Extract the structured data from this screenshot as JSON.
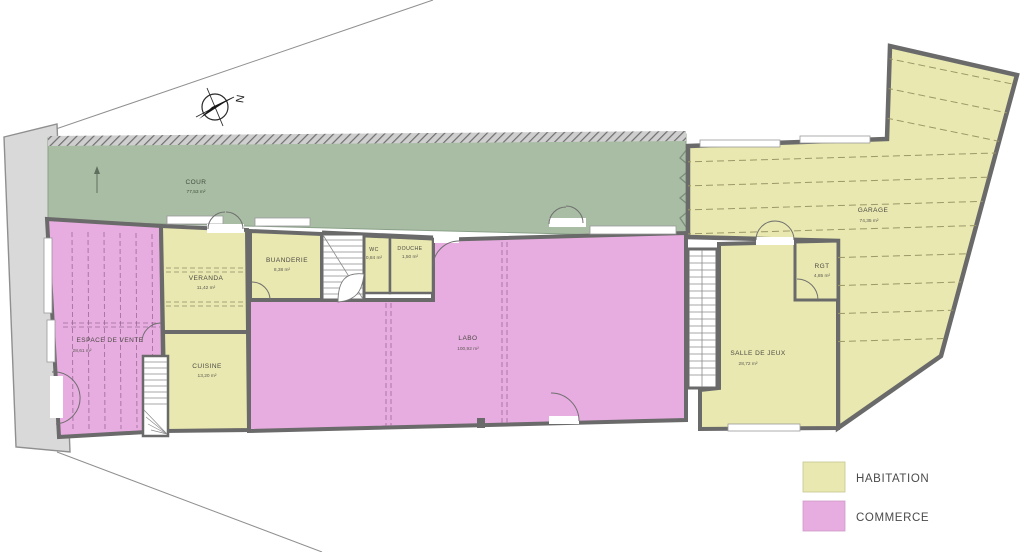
{
  "compass": {
    "label": "N"
  },
  "rooms": [
    {
      "id": "cour",
      "name": "COUR",
      "area": "77,53 m²",
      "category": "exterior"
    },
    {
      "id": "espace-de-vente",
      "name": "ESPACE DE VENTE",
      "area": "28,61 m²",
      "category": "commerce"
    },
    {
      "id": "veranda",
      "name": "VERANDA",
      "area": "11,42 m²",
      "category": "habitation"
    },
    {
      "id": "buanderie",
      "name": "BUANDERIE",
      "area": "8,38 m²",
      "category": "habitation"
    },
    {
      "id": "wc",
      "name": "WC",
      "area": "0,84 m²",
      "category": "habitation"
    },
    {
      "id": "douche",
      "name": "DOUCHE",
      "area": "1,50 m²",
      "category": "habitation"
    },
    {
      "id": "labo",
      "name": "LABO",
      "area": "100,92 m²",
      "category": "commerce"
    },
    {
      "id": "cuisine",
      "name": "CUISINE",
      "area": "13,20 m²",
      "category": "habitation"
    },
    {
      "id": "salle-de-jeux",
      "name": "SALLE DE JEUX",
      "area": "28,72 m²",
      "category": "habitation"
    },
    {
      "id": "rgt",
      "name": "RGT",
      "area": "4,85 m²",
      "category": "habitation"
    },
    {
      "id": "garage",
      "name": "GARAGE",
      "area": "74,35 m²",
      "category": "habitation"
    }
  ],
  "legend": {
    "items": [
      {
        "label": "HABITATION",
        "color": "#e8e8b0"
      },
      {
        "label": "COMMERCE",
        "color": "#e7ace0"
      }
    ]
  },
  "colors": {
    "habitation": "#e8e8b0",
    "commerce": "#e7ace0",
    "courtyard": "#a9bda4",
    "wall": "#6a6a6a",
    "sidewalk": "#d9d9d9",
    "boundary": "#8f8f8f",
    "background": "#ffffff"
  }
}
